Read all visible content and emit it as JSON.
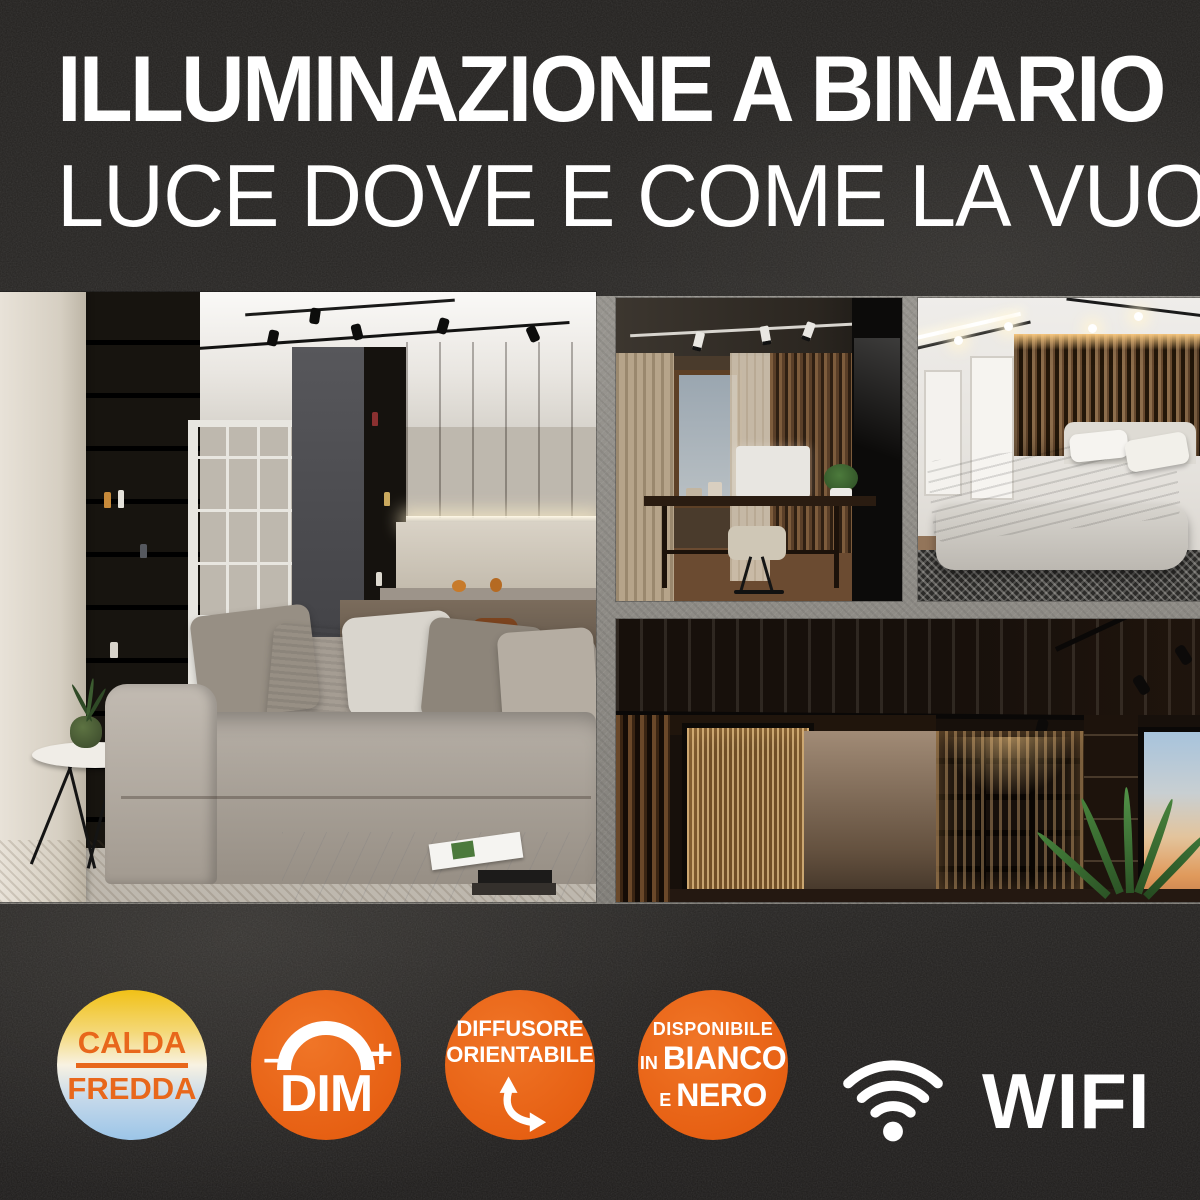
{
  "header": {
    "title": "ILLUMINAZIONE A BINARIO",
    "subtitle": "LUCE DOVE E COME LA VUOI!"
  },
  "badges": {
    "color_temperature": {
      "top": "CALDA",
      "bottom": "FREDDA"
    },
    "dimmer": {
      "minus": "−",
      "plus": "+",
      "label": "DIM"
    },
    "diffuser": {
      "line1": "DIFFUSORE",
      "line2": "ORIENTABILE"
    },
    "finishes": {
      "line1": "DISPONIBILE",
      "in": "IN",
      "white": "BIANCO",
      "and": "E",
      "black": "NERO"
    },
    "wifi": {
      "label": "WIFI"
    }
  },
  "icons": {
    "dimmer": "dim-arc-icon",
    "diffuser": "curved-double-arrow-icon",
    "wifi": "wifi-icon"
  },
  "photos": [
    {
      "name": "living-room-track-lighting"
    },
    {
      "name": "home-office-track-lighting"
    },
    {
      "name": "bedroom-track-lighting"
    },
    {
      "name": "hallway-library-track-lighting"
    }
  ],
  "colors": {
    "accent_orange": "#EB6A1B",
    "badge_text_orange": "#E8671B",
    "warm_gradient_top": "#F1C117",
    "cool_gradient_bottom": "#9CC5E8",
    "background_dark": "#232120",
    "concrete_gap": "#8D8B86",
    "text_white": "#FFFFFF"
  }
}
